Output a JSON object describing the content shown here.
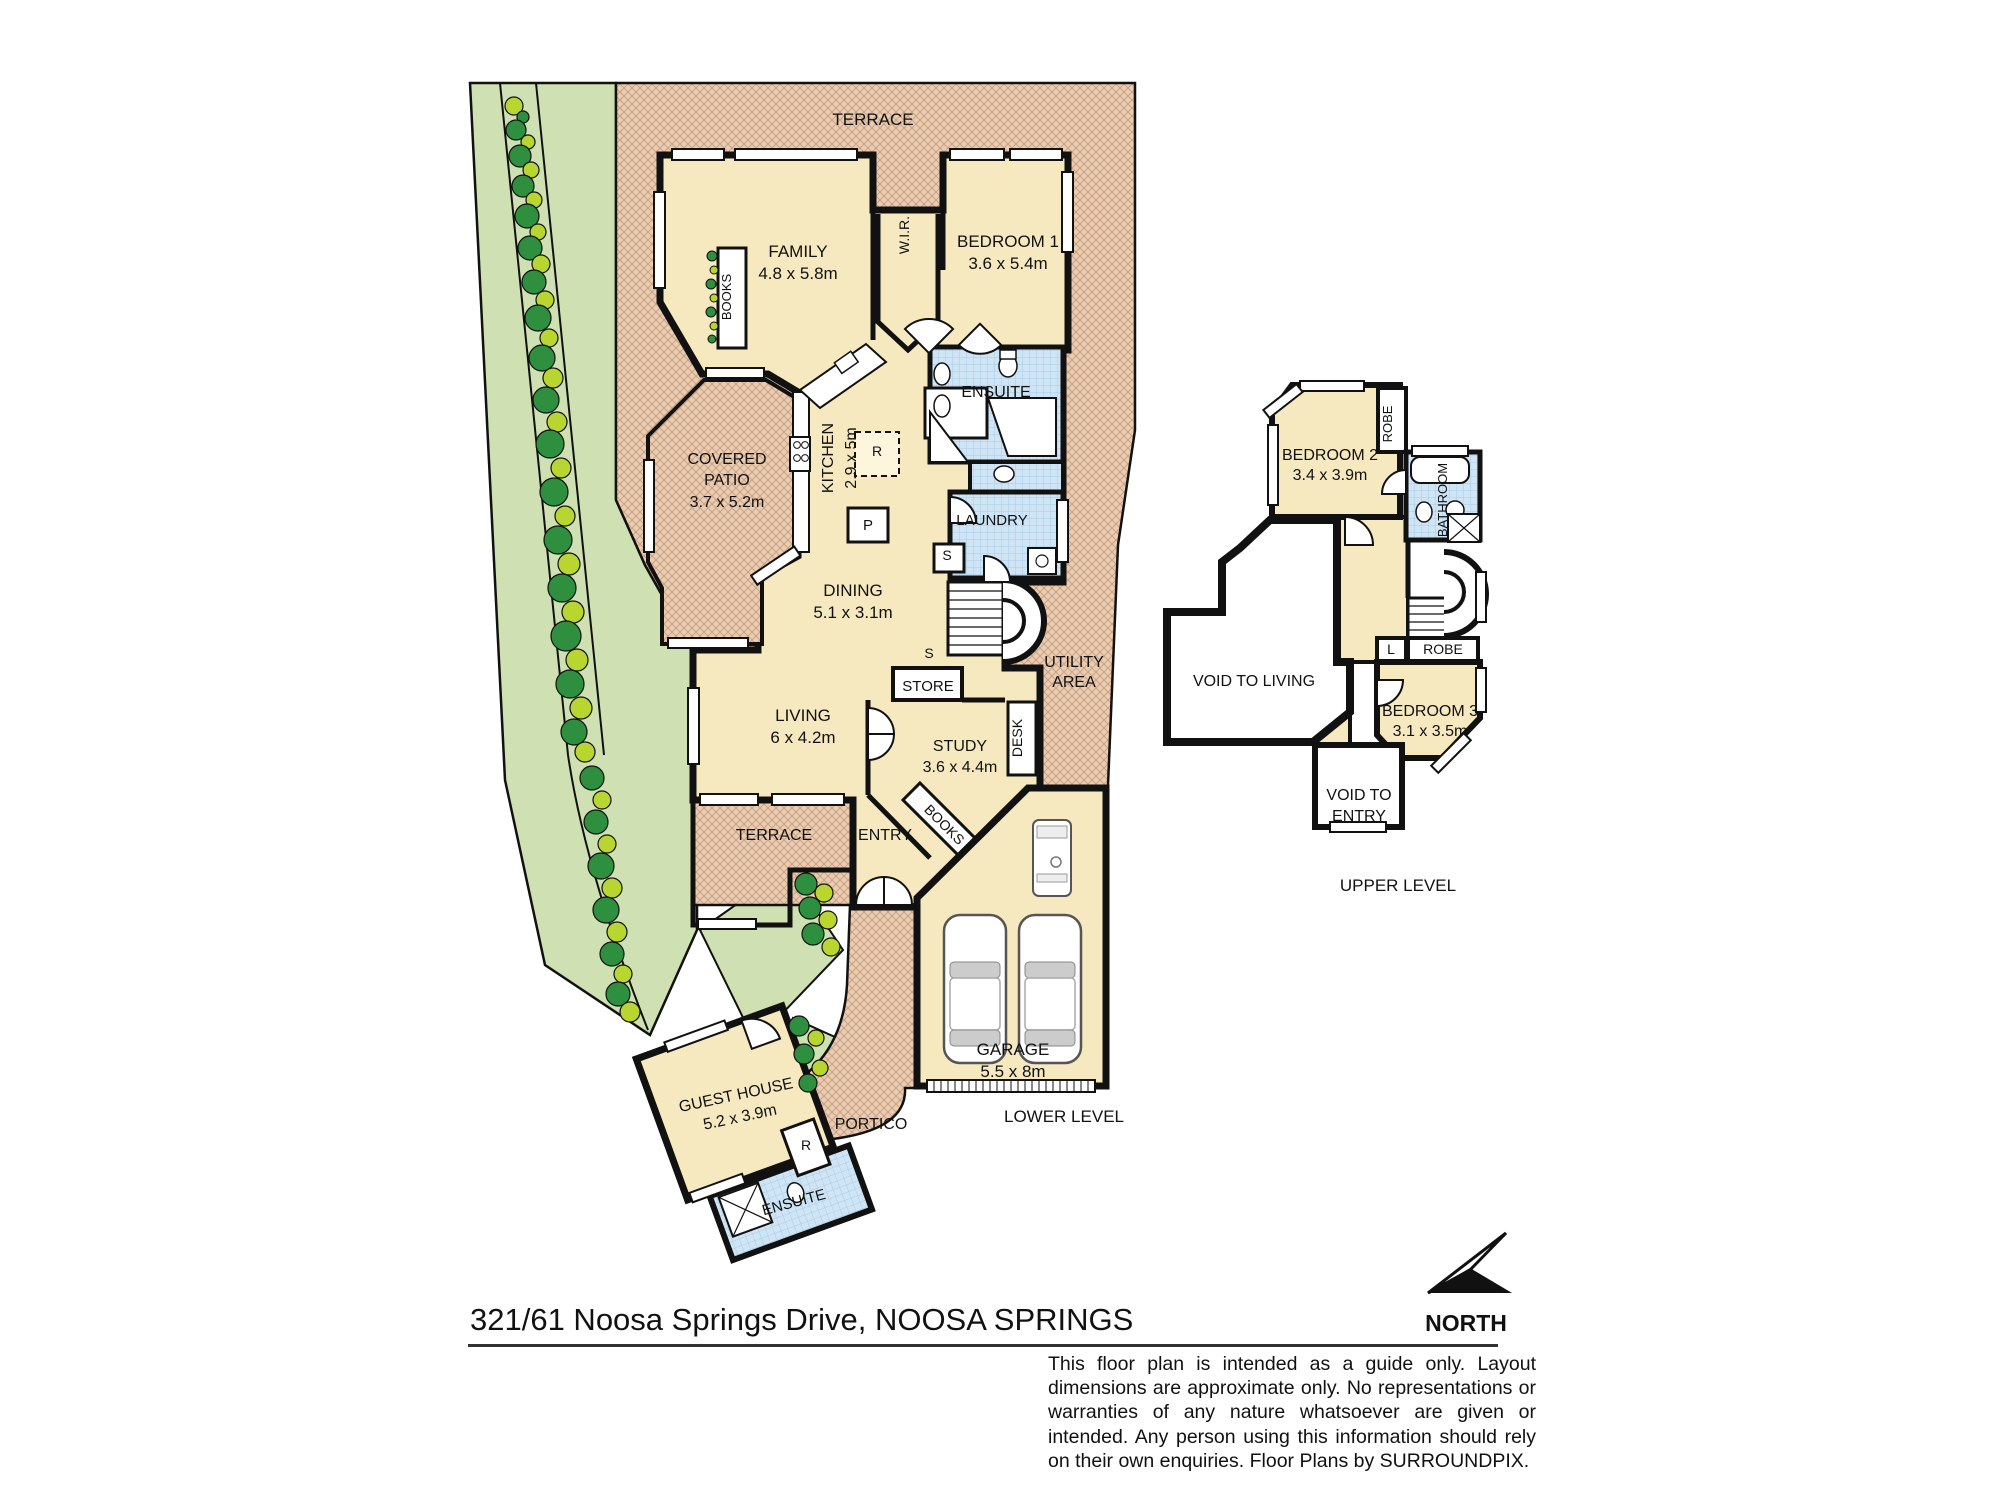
{
  "meta": {
    "title": "Floor plan - 321/61 Noosa Springs Drive, NOOSA SPRINGS",
    "levels": [
      "LOWER LEVEL",
      "UPPER LEVEL"
    ]
  },
  "address": {
    "text": "321/61 Noosa Springs Drive, NOOSA SPRINGS"
  },
  "north": {
    "label": "NORTH"
  },
  "disclaimer": {
    "text": "This floor plan is intended as a guide only. Layout dimensions are approximate only. No representations or warranties of any nature whatsoever are given or intended. Any person using this information should rely on their own enquiries. Floor Plans by  SURROUNDPIX."
  },
  "colors": {
    "room_fill": "#f6e9c0",
    "hatch_fill": "#e9cdb2",
    "hatch_line": "#c79b7d",
    "wet_fill": "#cfe5f5",
    "wet_line": "#a9cbe3",
    "garden_fill": "#cfe0b2",
    "tree_dark": "#2e8f3e",
    "tree_light": "#b9d52f",
    "wall": "#111111"
  },
  "rooms_lower": [
    {
      "name": "Family",
      "dims": "4.8 x 5.8m"
    },
    {
      "name": "Bedroom 1",
      "dims": "3.6 x 5.4m"
    },
    {
      "name": "W.I.R.",
      "dims": ""
    },
    {
      "name": "Ensuite",
      "dims": ""
    },
    {
      "name": "Covered Patio",
      "dims": "3.7 x 5.2m"
    },
    {
      "name": "Kitchen",
      "dims": "2.9 x 5m"
    },
    {
      "name": "Laundry",
      "dims": ""
    },
    {
      "name": "Dining",
      "dims": "5.1 x 3.1m"
    },
    {
      "name": "Living",
      "dims": "6 x 4.2m"
    },
    {
      "name": "Study",
      "dims": "3.6 x 4.4m"
    },
    {
      "name": "Store",
      "dims": ""
    },
    {
      "name": "Utility Area",
      "dims": ""
    },
    {
      "name": "Terrace",
      "dims": ""
    },
    {
      "name": "Entry",
      "dims": ""
    },
    {
      "name": "Garage",
      "dims": "5.5 x 8m"
    },
    {
      "name": "Portico",
      "dims": ""
    },
    {
      "name": "Guest House",
      "dims": "5.2 x 3.9m"
    },
    {
      "name": "Guest Ensuite",
      "dims": ""
    }
  ],
  "rooms_upper": [
    {
      "name": "Bedroom 2",
      "dims": "3.4 x 3.9m"
    },
    {
      "name": "Bedroom 3",
      "dims": "3.1 x 3.5m"
    },
    {
      "name": "Bathroom",
      "dims": ""
    },
    {
      "name": "Robe",
      "dims": ""
    },
    {
      "name": "Void to Living",
      "dims": ""
    },
    {
      "name": "Void to Entry",
      "dims": ""
    }
  ],
  "labels": [
    {
      "name": "terrace-top",
      "t": "TERRACE",
      "x": 873,
      "y": 125,
      "s": 17
    },
    {
      "name": "family",
      "t": "FAMILY",
      "x": 798,
      "y": 257,
      "s": 17
    },
    {
      "name": "family-dims",
      "t": "4.8 x 5.8m",
      "x": 798,
      "y": 279,
      "s": 17
    },
    {
      "name": "books-family",
      "t": "BOOKS",
      "x": 731,
      "y": 297,
      "s": 13,
      "r": -90
    },
    {
      "name": "wir",
      "t": "W.I.R.",
      "x": 909,
      "y": 235,
      "s": 14,
      "r": -90
    },
    {
      "name": "bedroom1",
      "t": "BEDROOM 1",
      "x": 1008,
      "y": 247,
      "s": 17
    },
    {
      "name": "bedroom1-dims",
      "t": "3.6 x 5.4m",
      "x": 1008,
      "y": 269,
      "s": 17
    },
    {
      "name": "ensuite",
      "t": "ENSUITE",
      "x": 996,
      "y": 397,
      "s": 16
    },
    {
      "name": "covered-patio-1",
      "t": "COVERED",
      "x": 727,
      "y": 464,
      "s": 16
    },
    {
      "name": "covered-patio-2",
      "t": "PATIO",
      "x": 727,
      "y": 485,
      "s": 16
    },
    {
      "name": "covered-patio-dims",
      "t": "3.7 x 5.2m",
      "x": 727,
      "y": 507,
      "s": 16
    },
    {
      "name": "kitchen",
      "t": "KITCHEN",
      "x": 833,
      "y": 458,
      "s": 16,
      "r": -90
    },
    {
      "name": "kitchen-dims",
      "t": "2.9 x 5m",
      "x": 856,
      "y": 458,
      "s": 16,
      "r": -90
    },
    {
      "name": "fridge",
      "t": "R",
      "x": 877,
      "y": 456,
      "s": 14
    },
    {
      "name": "pantry",
      "t": "P",
      "x": 868,
      "y": 530,
      "s": 15
    },
    {
      "name": "laundry",
      "t": "LAUNDRY",
      "x": 992,
      "y": 525,
      "s": 15
    },
    {
      "name": "laundry-cupboard",
      "t": "S",
      "x": 947,
      "y": 560,
      "s": 14
    },
    {
      "name": "dining",
      "t": "DINING",
      "x": 853,
      "y": 596,
      "s": 17
    },
    {
      "name": "dining-dims",
      "t": "5.1 x 3.1m",
      "x": 853,
      "y": 618,
      "s": 17
    },
    {
      "name": "stair-storage",
      "t": "S",
      "x": 929,
      "y": 658,
      "s": 14
    },
    {
      "name": "store",
      "t": "STORE",
      "x": 928,
      "y": 691,
      "s": 15
    },
    {
      "name": "living",
      "t": "LIVING",
      "x": 803,
      "y": 721,
      "s": 17
    },
    {
      "name": "living-dims",
      "t": "6 x 4.2m",
      "x": 803,
      "y": 743,
      "s": 17
    },
    {
      "name": "study",
      "t": "STUDY",
      "x": 960,
      "y": 751,
      "s": 16
    },
    {
      "name": "study-dims",
      "t": "3.6 x 4.4m",
      "x": 960,
      "y": 772,
      "s": 16
    },
    {
      "name": "desk",
      "t": "DESK",
      "x": 1022,
      "y": 738,
      "s": 14,
      "r": -90
    },
    {
      "name": "utility-1",
      "t": "UTILITY",
      "x": 1074,
      "y": 667,
      "s": 16
    },
    {
      "name": "utility-2",
      "t": "AREA",
      "x": 1074,
      "y": 687,
      "s": 16
    },
    {
      "name": "books-study",
      "t": "BOOKS",
      "x": 941,
      "y": 828,
      "s": 14,
      "r": 45
    },
    {
      "name": "terrace-lower",
      "t": "TERRACE",
      "x": 774,
      "y": 840,
      "s": 16
    },
    {
      "name": "entry",
      "t": "ENTRY",
      "x": 885,
      "y": 840,
      "s": 16
    },
    {
      "name": "guest-house",
      "t": "GUEST HOUSE",
      "x": 737,
      "y": 1100,
      "s": 16,
      "r": -12
    },
    {
      "name": "guest-house-dims",
      "t": "5.2 x 3.9m",
      "x": 741,
      "y": 1122,
      "s": 16,
      "r": -12
    },
    {
      "name": "guest-fridge",
      "t": "R",
      "x": 806,
      "y": 1150,
      "s": 14
    },
    {
      "name": "guest-ensuite",
      "t": "ENSUITE",
      "x": 795,
      "y": 1207,
      "s": 15,
      "r": -15
    },
    {
      "name": "portico",
      "t": "PORTICO",
      "x": 871,
      "y": 1129,
      "s": 16
    },
    {
      "name": "garage",
      "t": "GARAGE",
      "x": 1013,
      "y": 1055,
      "s": 17
    },
    {
      "name": "garage-dims",
      "t": "5.5 x 8m",
      "x": 1013,
      "y": 1077,
      "s": 17
    },
    {
      "name": "lower-level",
      "t": "LOWER LEVEL",
      "x": 1064,
      "y": 1122,
      "s": 17
    },
    {
      "name": "bedroom2",
      "t": "BEDROOM 2",
      "x": 1330,
      "y": 460,
      "s": 16
    },
    {
      "name": "bedroom2-dims",
      "t": "3.4 x 3.9m",
      "x": 1330,
      "y": 480,
      "s": 16
    },
    {
      "name": "robe-upper",
      "t": "ROBE",
      "x": 1392,
      "y": 424,
      "s": 13,
      "r": -90
    },
    {
      "name": "bathroom",
      "t": "BATHROOM",
      "x": 1447,
      "y": 500,
      "s": 13,
      "r": -90
    },
    {
      "name": "void-living",
      "t": "VOID TO LIVING",
      "x": 1254,
      "y": 686,
      "s": 16
    },
    {
      "name": "linen",
      "t": "L",
      "x": 1391,
      "y": 654,
      "s": 14
    },
    {
      "name": "robe-lower",
      "t": "ROBE",
      "x": 1443,
      "y": 654,
      "s": 14
    },
    {
      "name": "bedroom3",
      "t": "BEDROOM 3",
      "x": 1430,
      "y": 716,
      "s": 16
    },
    {
      "name": "bedroom3-dims",
      "t": "3.1 x 3.5m",
      "x": 1430,
      "y": 736,
      "s": 16
    },
    {
      "name": "void-entry-1",
      "t": "VOID TO",
      "x": 1359,
      "y": 800,
      "s": 16
    },
    {
      "name": "void-entry-2",
      "t": "ENTRY",
      "x": 1359,
      "y": 821,
      "s": 16
    },
    {
      "name": "upper-level",
      "t": "UPPER LEVEL",
      "x": 1398,
      "y": 891,
      "s": 17
    },
    {
      "name": "north",
      "t": "NORTH",
      "x": 1466,
      "y": 1331,
      "s": 23,
      "w": "bold"
    }
  ]
}
